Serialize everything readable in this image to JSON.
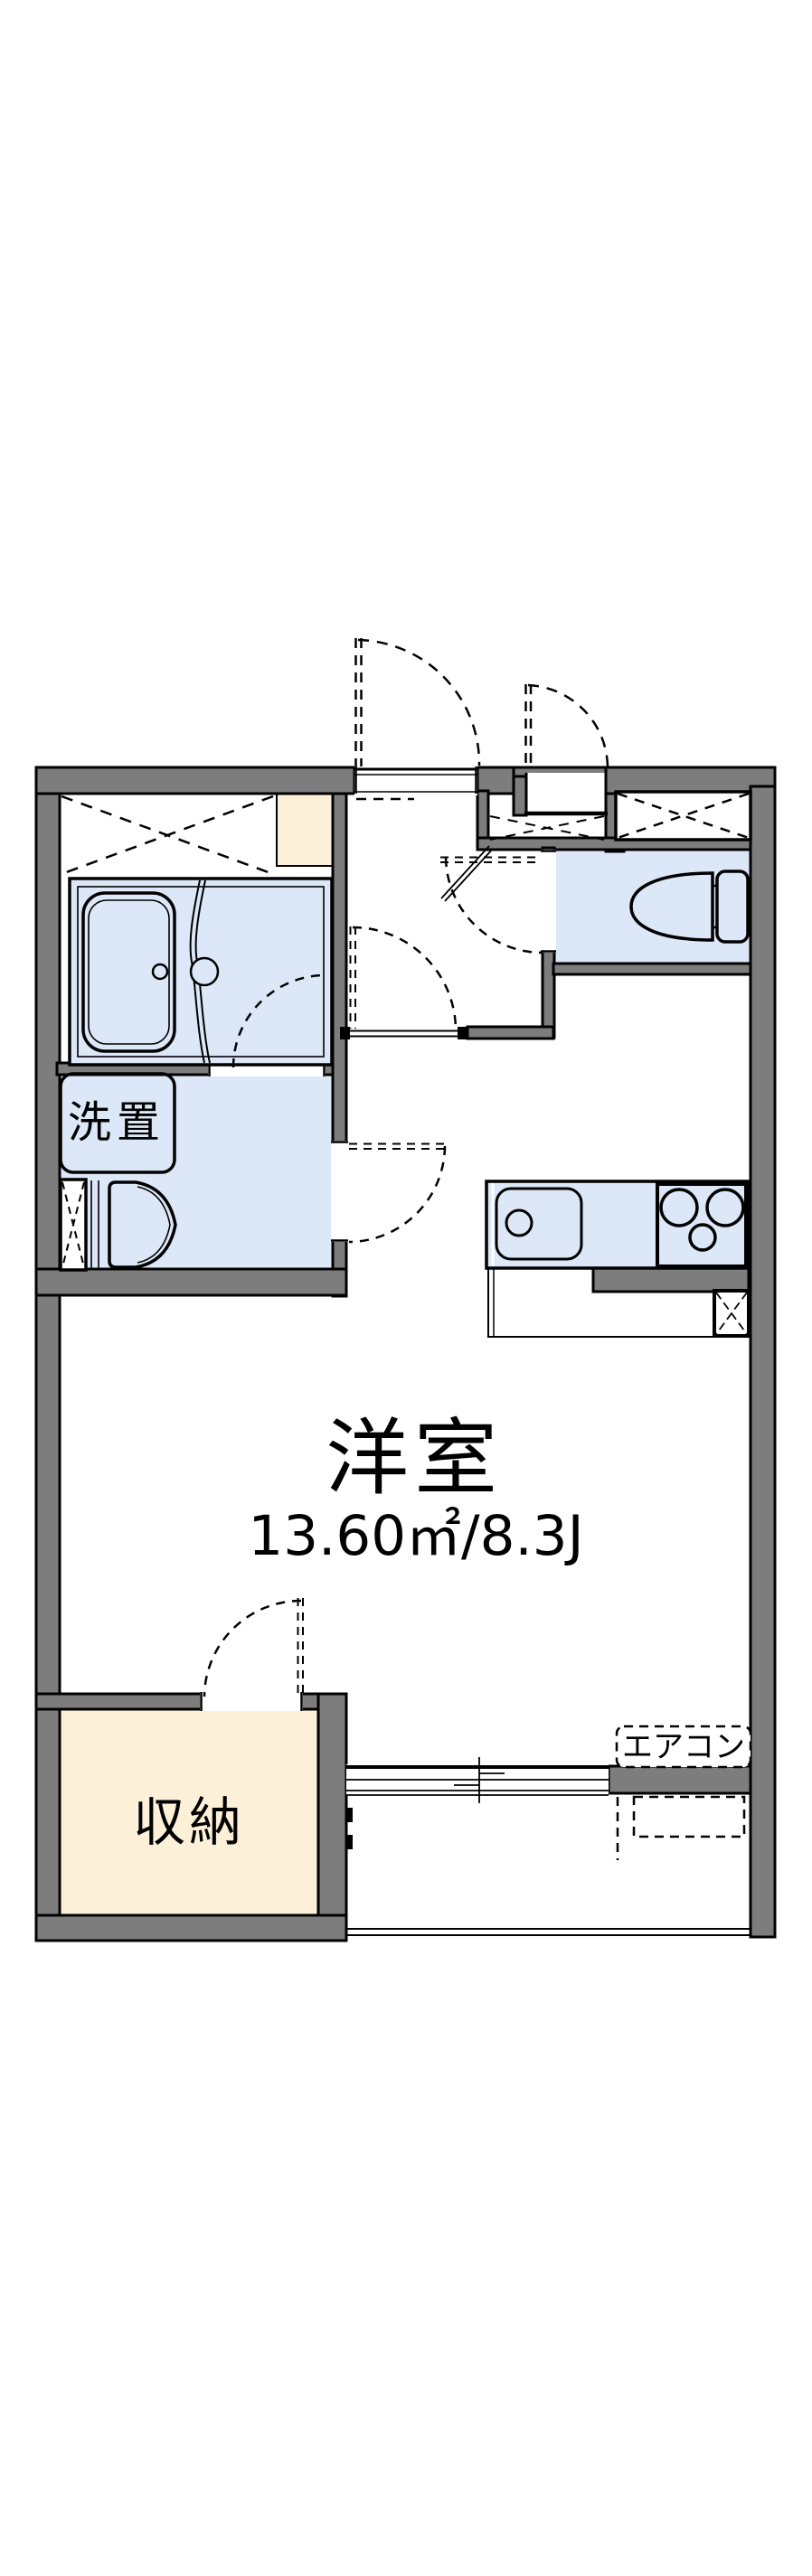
{
  "floor_plan": {
    "labels": {
      "main_room_name": "洋室",
      "main_room_size": "13.60㎡/8.3J",
      "closet": "収納",
      "washer_place": "洗置",
      "aircon": "エアコン"
    },
    "colors": {
      "wall_gray": "#7d7d7d",
      "wet_area_blue": "#dce8f7",
      "closet_beige": "#fcf0d8",
      "line_black": "#000000",
      "background": "#ffffff"
    }
  }
}
